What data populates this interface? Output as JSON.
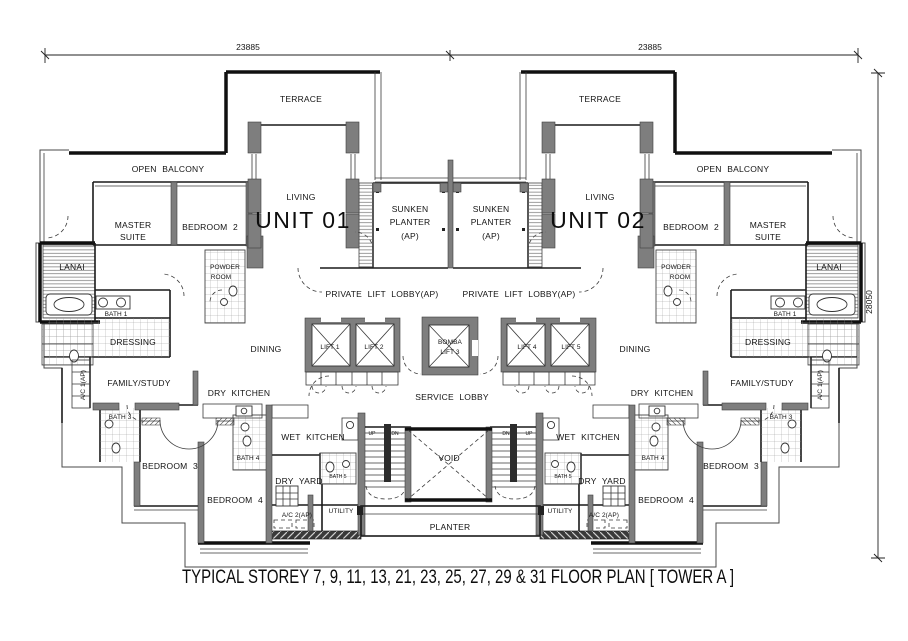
{
  "caption": "TYPICAL STOREY 7, 9, 11, 13, 21, 23, 25, 27, 29 & 31 FLOOR PLAN  [ TOWER A ]",
  "dimensions": {
    "width": "23885",
    "height": "28050"
  },
  "units": {
    "unit1": "UNIT 01",
    "unit2": "UNIT 02"
  },
  "labels": {
    "terrace": "TERRACE",
    "open_balcony": "OPEN BALCONY",
    "living": "LIVING",
    "master_line1": "MASTER",
    "master_line2": "SUITE",
    "bedroom2": "BEDROOM 2",
    "sunken_line1": "SUNKEN",
    "sunken_line2": "PLANTER",
    "sunken_line3": "(AP)",
    "lanai": "LANAI",
    "powder_line1": "POWDER",
    "powder_line2": "ROOM",
    "bath1": "BATH 1",
    "dressing": "DRESSING",
    "dining": "DINING",
    "family_study": "FAMILY/STUDY",
    "dry_kitchen": "DRY KITCHEN",
    "ac1": "A/C 1(AP)",
    "private_lift_lobby": "PRIVATE LIFT LOBBY(AP)",
    "service_lobby": "SERVICE LOBBY",
    "wet_kitchen": "WET KITCHEN",
    "bath3": "BATH 3",
    "bath4": "BATH 4",
    "bath5": "BATH 5",
    "bedroom3": "BEDROOM 3",
    "bedroom4": "BEDROOM 4",
    "dry_yard": "DRY YARD",
    "utility": "UTILITY",
    "ac2": "A/C 2(AP)",
    "void": "VOID",
    "planter": "PLANTER",
    "up": "UP",
    "dn": "DN"
  },
  "lifts": {
    "lift1": "LIFT 1",
    "lift2": "LIFT 2",
    "bomba_line1": "BOMBA",
    "bomba_line2": "LIFT 3",
    "lift4": "LIFT 4",
    "lift5": "LIFT 5"
  },
  "colors": {
    "line": "#141414",
    "wall_gray": "#7e7e7e",
    "background": "#ffffff"
  }
}
